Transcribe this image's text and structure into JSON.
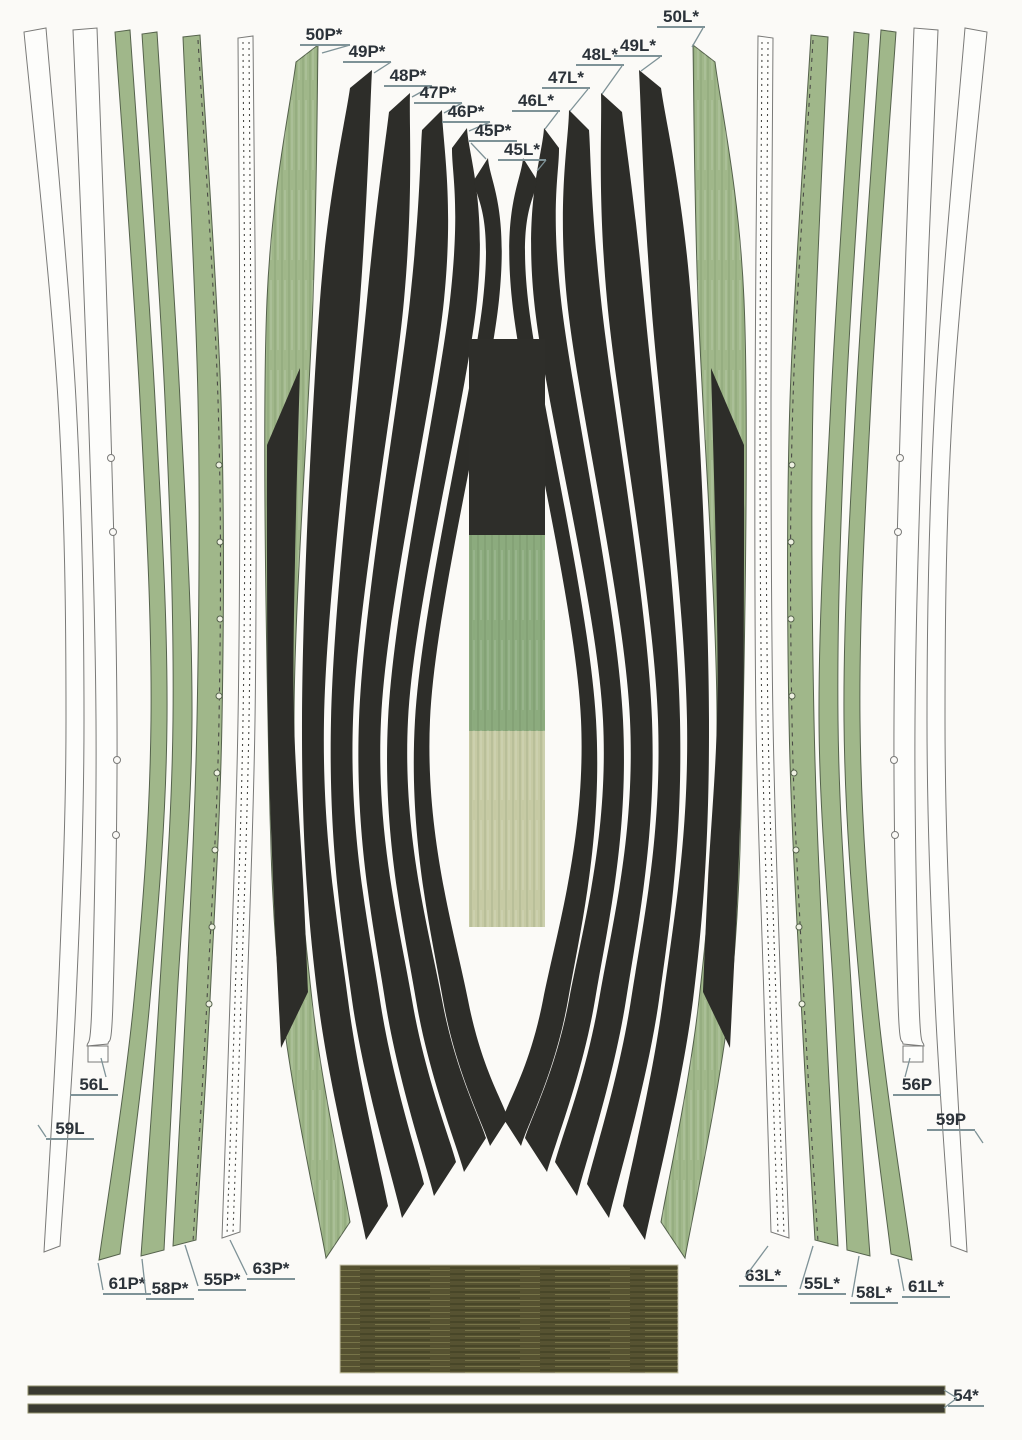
{
  "sheet_type": "cut-out parts sheet",
  "labels": [
    {
      "id": "50P",
      "text": "50P*"
    },
    {
      "id": "49P",
      "text": "49P*"
    },
    {
      "id": "48P",
      "text": "48P*"
    },
    {
      "id": "47P",
      "text": "47P*"
    },
    {
      "id": "46P",
      "text": "46P*"
    },
    {
      "id": "45P",
      "text": "45P*"
    },
    {
      "id": "45L",
      "text": "45L*"
    },
    {
      "id": "46L",
      "text": "46L*"
    },
    {
      "id": "47L",
      "text": "47L*"
    },
    {
      "id": "48L",
      "text": "48L*"
    },
    {
      "id": "49L",
      "text": "49L*"
    },
    {
      "id": "50L",
      "text": "50L*"
    },
    {
      "id": "56L",
      "text": "56L"
    },
    {
      "id": "59L",
      "text": "59L"
    },
    {
      "id": "56P",
      "text": "56P"
    },
    {
      "id": "59P",
      "text": "59P"
    },
    {
      "id": "61P",
      "text": "61P*"
    },
    {
      "id": "58P",
      "text": "58P*"
    },
    {
      "id": "55P",
      "text": "55P*"
    },
    {
      "id": "63P",
      "text": "63P*"
    },
    {
      "id": "63L",
      "text": "63L*"
    },
    {
      "id": "55L",
      "text": "55L*"
    },
    {
      "id": "58L",
      "text": "58L*"
    },
    {
      "id": "61L",
      "text": "61L*"
    },
    {
      "id": "54",
      "text": "54*"
    }
  ],
  "colors": {
    "page": "#fbfaf7",
    "outline": "#7a7a78",
    "strip_white": "#fdfdfb",
    "strip_green": "#a0b78a",
    "strip_green_edge": "#55624c",
    "plank_black": "#2d2d29",
    "swatch_dark": "#2e2e2a",
    "swatch_green": "#8cab7e",
    "swatch_light": "#c6caa4",
    "wood_olive": "#565231",
    "batten_dark": "#3a3a31",
    "batten_edge": "#8f8f6a",
    "label_text": "#2b3239",
    "label_line": "#7e9297"
  }
}
